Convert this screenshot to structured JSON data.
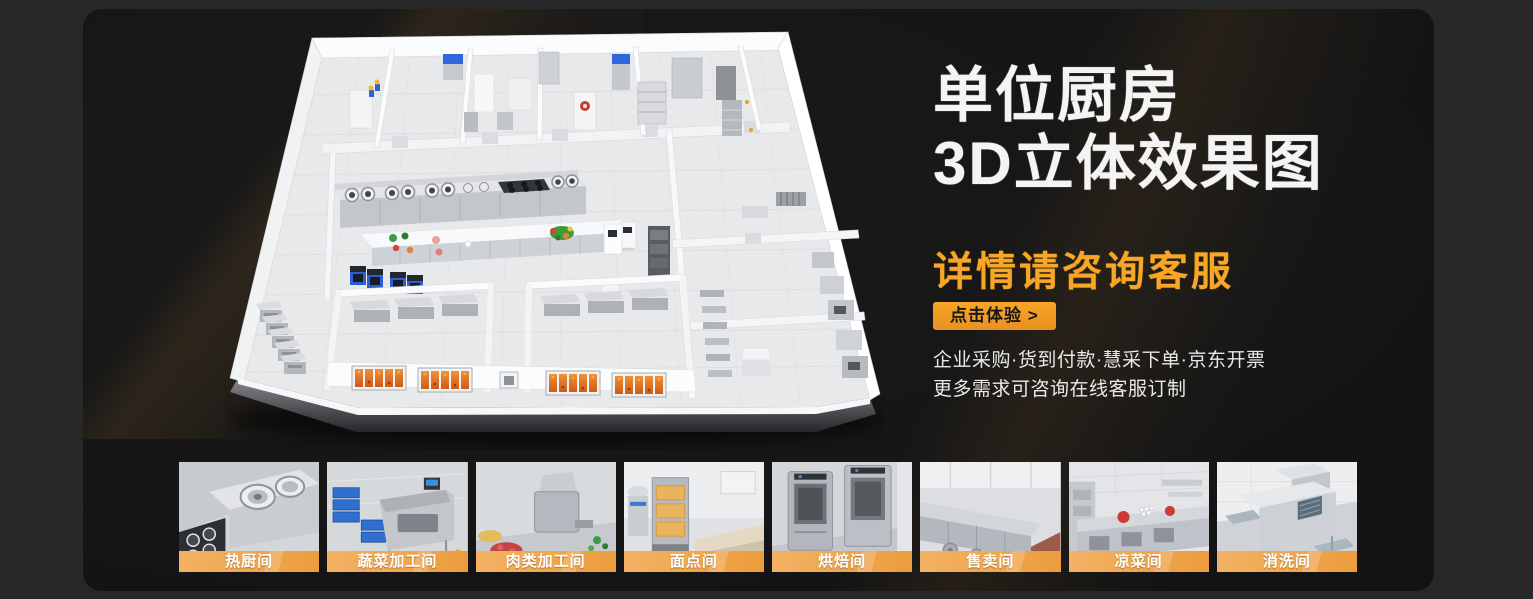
{
  "hero": {
    "title_line1": "单位厨房",
    "title_line2": "3D立体效果图",
    "subtitle": "详情请咨询客服",
    "cta_label": "点击体验 >",
    "desc_line1": "企业采购·货到付款·慧采下单·京东开票",
    "desc_line2": "更多需求可咨询在线客服订制"
  },
  "thumbnails": [
    {
      "label": "热厨间"
    },
    {
      "label": "蔬菜加工间"
    },
    {
      "label": "肉类加工间"
    },
    {
      "label": "面点间"
    },
    {
      "label": "烘焙间"
    },
    {
      "label": "售卖间"
    },
    {
      "label": "凉菜间"
    },
    {
      "label": "消洗间"
    }
  ],
  "colors": {
    "accent": "#F7A626",
    "accent-dark": "#E89121",
    "bar-light": "#F3B264",
    "bar-dark": "#EC9C3C",
    "page-bg": "#282828",
    "panel-bg": "#161616",
    "title-color": "#F4F4F4",
    "desc-color": "#E9E9E9",
    "cta-text": "#161616"
  }
}
